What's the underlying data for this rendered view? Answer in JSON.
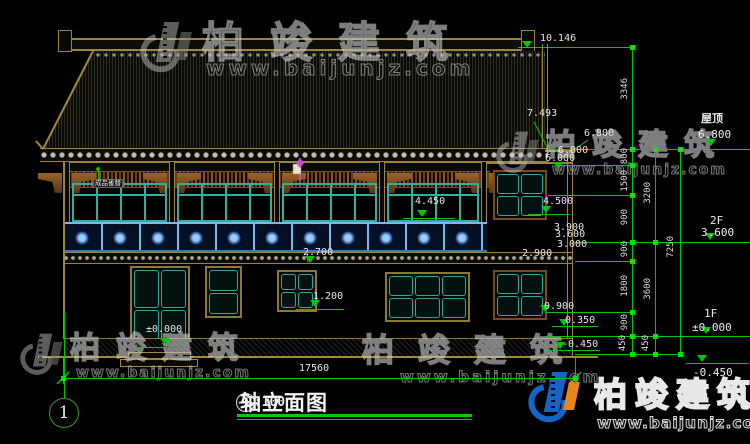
{
  "drawing": {
    "sheet_no": "1",
    "title": {
      "axis_start": "1",
      "axis_end": "9",
      "separator": "-",
      "name": "轴立面图",
      "scale": "1:100"
    },
    "total_width_dim": "17560",
    "levels": {
      "roof_label": "屋顶",
      "roof_value": "6.800",
      "f2_label": "2F",
      "f2_value": "3.600",
      "f1_label": "1F",
      "f1_value": "±0.000",
      "ground_value": "-0.450"
    },
    "bracket_note": "成品雀替",
    "elevations": {
      "e10146": "10.146",
      "e7493": "7.493",
      "e6800": "6.800",
      "e6800b": "6.800",
      "e6000": "6.000",
      "e4450": "4.450",
      "e4500": "4.500",
      "e3900": "3.900",
      "e3600": "3.600",
      "e3000": "3.000",
      "e2900": "2.900",
      "e2700": "2.700",
      "e1200": "1.200",
      "e0900": "0.900",
      "e0350": "0.350",
      "em0450": "-0.450",
      "epm0000": "±0.000"
    },
    "dim_chains": {
      "inner": [
        "3346",
        "800",
        "1500",
        "900",
        "900",
        "1800",
        "900",
        "450"
      ],
      "middle": [
        "3200",
        "3600",
        "450"
      ],
      "outer": [
        "7250"
      ]
    }
  },
  "watermark": {
    "brand": "柏竣建筑",
    "url": "www.baijunjz.com"
  },
  "colors": {
    "background": "#000000",
    "dim_green": "#00c800",
    "cad_white": "#e6e6e6",
    "outline_tan": "#a08a3a",
    "window_teal": "#2ea89a",
    "railing_blue": "#4a90d8",
    "bracket_brown": "#8a5a28",
    "logo_blue": "#1565c8",
    "logo_orange": "#e8821e",
    "annotation_magenta": "#d24ad2"
  }
}
